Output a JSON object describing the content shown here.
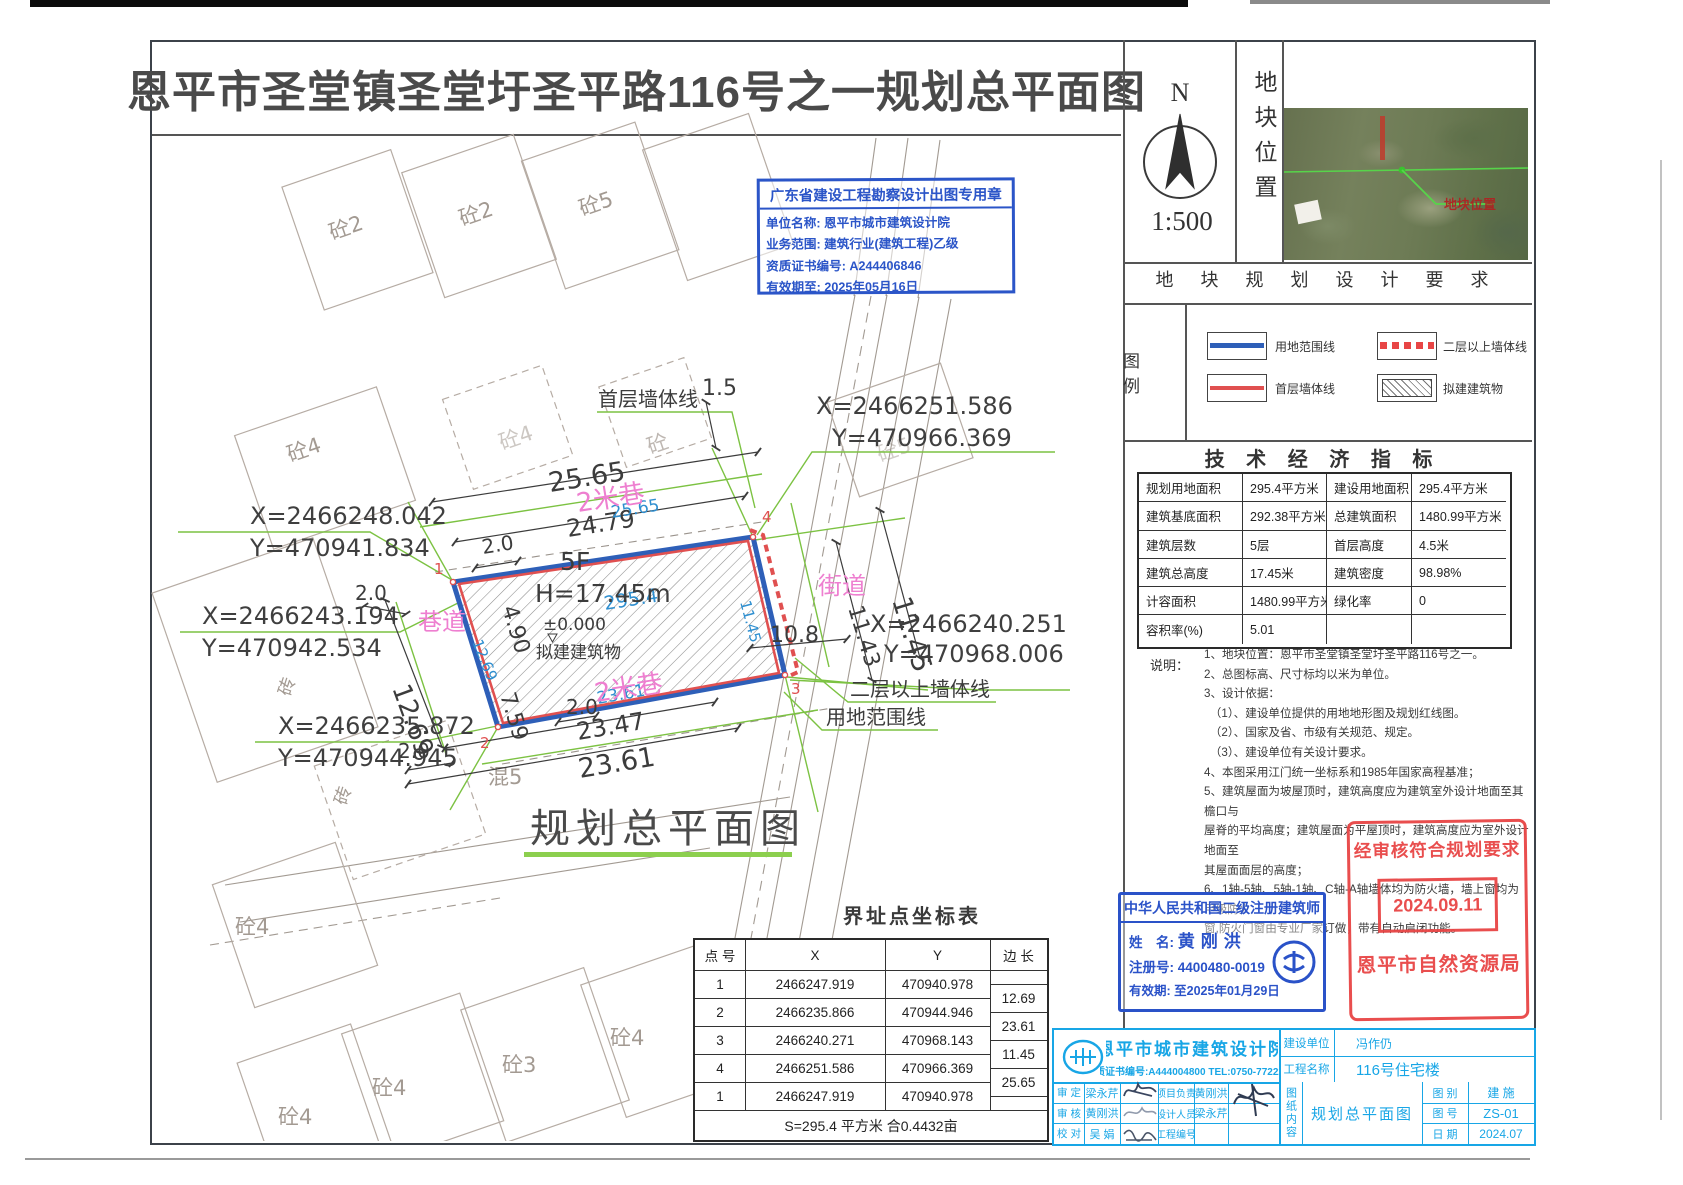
{
  "sheet": {
    "title": "恩平市圣堂镇圣堂圩圣平路116号之一规划总平面图",
    "north_label": "N",
    "scale": "1:500",
    "location_label": "地块位置",
    "satellite_overlay": "地块位置",
    "requirements_title": "地 块 规 划 设 计 要 求"
  },
  "legend": {
    "label": "图  例",
    "items": [
      {
        "label": "用地范围线"
      },
      {
        "label": "二层以上墙体线"
      },
      {
        "label": "首层墙体线"
      },
      {
        "label": "拟建建筑物"
      }
    ]
  },
  "indicators": {
    "title": "技 术 经 济 指 标",
    "rows": [
      [
        "规划用地面积",
        "295.4平方米",
        "建设用地面积",
        "295.4平方米"
      ],
      [
        "建筑基底面积",
        "292.38平方米",
        "总建筑面积",
        "1480.99平方米"
      ],
      [
        "建筑层数",
        "5层",
        "首层高度",
        "4.5米"
      ],
      [
        "建筑总高度",
        "17.45米",
        "建筑密度",
        "98.98%"
      ],
      [
        "计容面积",
        "1480.99平方米",
        "绿化率",
        "0"
      ],
      [
        "容积率(%)",
        "5.01",
        "",
        ""
      ]
    ]
  },
  "notes": {
    "label": "说明：",
    "lines": [
      "1、地块位置：恩平市圣堂镇圣堂圩圣平路116号之一。",
      "2、总图标高、尺寸标均以米为单位。",
      "3、设计依据：",
      "　（1）、建设单位提供的用地地形图及规划红线图。",
      "　（2）、国家及省、市级有关规范、规定。",
      "　（3）、建设单位有关设计要求。",
      "4、本图采用江门统一坐标系和1985年国家高程基准；",
      "5、建筑屋面为坡屋顶时，建筑高度应为建筑室外设计地面至其檐口与",
      "屋脊的平均高度；建筑屋面为平屋顶时，建筑高度应为室外设计地面至",
      "其屋面面层的高度；",
      "6、1轴-5轴、5轴-1轴、C轴-A轴墙体均为防火墙，墙上窗均为甲级防火",
      "窗,防火门窗由专业厂家订做，带有自动启闭功能。"
    ]
  },
  "stamps": {
    "survey": {
      "title": "广东省建设工程勘察设计出图专用章",
      "line1": "单位名称: 恩平市城市建筑设计院",
      "line2": "业务范围: 建筑行业(建筑工程)乙级",
      "line3": "资质证书编号: A244406846",
      "line4": "有效期至: 2025年05月16日"
    },
    "architect": {
      "title": "中华人民共和国二级注册建筑师",
      "name_label": "姓　名:",
      "name": "黄刚洪",
      "reg_label": "注册号:",
      "reg": "4400480-0019",
      "valid_label": "有效期:",
      "valid": "至2025年01月29日"
    },
    "approval": {
      "line1": "经审核符合规划要求",
      "date": "2024.09.11",
      "org": "恩平市自然资源局"
    }
  },
  "coord_table": {
    "title": "界址点坐标表",
    "headers": [
      "点 号",
      "X",
      "Y",
      "边 长"
    ],
    "rows": [
      [
        "1",
        "2466247.919",
        "470940.978"
      ],
      [
        "2",
        "2466235.866",
        "470944.946"
      ],
      [
        "3",
        "2466240.271",
        "470968.143"
      ],
      [
        "4",
        "2466251.586",
        "470966.369"
      ],
      [
        "1",
        "2466247.919",
        "470940.978"
      ]
    ],
    "edges": [
      "12.69",
      "23.61",
      "11.45",
      "25.65"
    ],
    "footer": "S=295.4 平方米 合0.4432亩"
  },
  "titleblock": {
    "institute": "恩平市城市建筑设计院",
    "cert": "资质证书编号:A444004800 TEL:0750-7722234",
    "client_label": "建设单位",
    "client": "冯作仍",
    "project_label": "工程名称",
    "project": "116号住宅楼",
    "shending_label": "审 定",
    "shending": "梁永芹",
    "shenhe_label": "审 核",
    "shenhe": "黄刚洪",
    "jiaodui_label": "校 对",
    "jiaodui": "吴 娟",
    "xmfz_label": "项目负责",
    "xmfz": "黄刚洪",
    "sjry_label": "设计人员",
    "sjry": "梁永芹",
    "gcbh_label": "工程编号",
    "gcbh": "",
    "content_label": "图纸内容",
    "content": "规划总平面图",
    "tb_label": "图 别",
    "tb": "建 施",
    "th_label": "图 号",
    "th": "ZS-01",
    "rq_label": "日 期",
    "rq": "2024.07"
  },
  "drawing": {
    "plan_title": "规划总平面图",
    "building": {
      "floors": "5F",
      "height": "H=17.45m",
      "level": "±0.000",
      "name": "拟建建筑物"
    },
    "edge_dims": {
      "top": "25.65",
      "left": "12.69",
      "bottom": "23.61",
      "right": "11.45",
      "area": "295.4"
    },
    "dims": {
      "top_2565": "25.65",
      "top_2479": "24.79",
      "top_20": "2.0",
      "right_15": "1.5",
      "left_490": "4.90",
      "left_759": "7.59",
      "left_1269": "12.69",
      "left_20": "2.0",
      "bl_20": "2.0",
      "bm_20": "2.0",
      "bot_2347": "23.47",
      "bot_2361": "23.61",
      "r_108": "10.8",
      "r_1143": "11.43",
      "r_1145": "11.45"
    },
    "coords": [
      {
        "x": "X=2466248.042",
        "y": "Y=470941.834"
      },
      {
        "x": "X=2466243.194",
        "y": "Y=470942.534"
      },
      {
        "x": "X=2466235.872",
        "y": "Y=470944.945"
      },
      {
        "x": "X=2466251.586",
        "y": "Y=470966.369"
      },
      {
        "x": "X=2466240.251",
        "y": "Y=470968.006"
      }
    ],
    "corners": [
      "1",
      "2",
      "3",
      "4"
    ],
    "roads": {
      "lane_top": "2米巷",
      "alley": "巷道",
      "street": "街道",
      "lane_bottom": "2米巷"
    },
    "leaders": {
      "first_floor": "首层墙体线",
      "upper": "二层以上墙体线",
      "boundary": "用地范围线"
    },
    "bg_labels": [
      "砼2",
      "砼2",
      "砼5",
      "砼4",
      "砼4",
      "砼",
      "砼5",
      "砖",
      "砖",
      "混5",
      "砼4",
      "砼4",
      "砼4",
      "砼3",
      "砼4"
    ]
  }
}
